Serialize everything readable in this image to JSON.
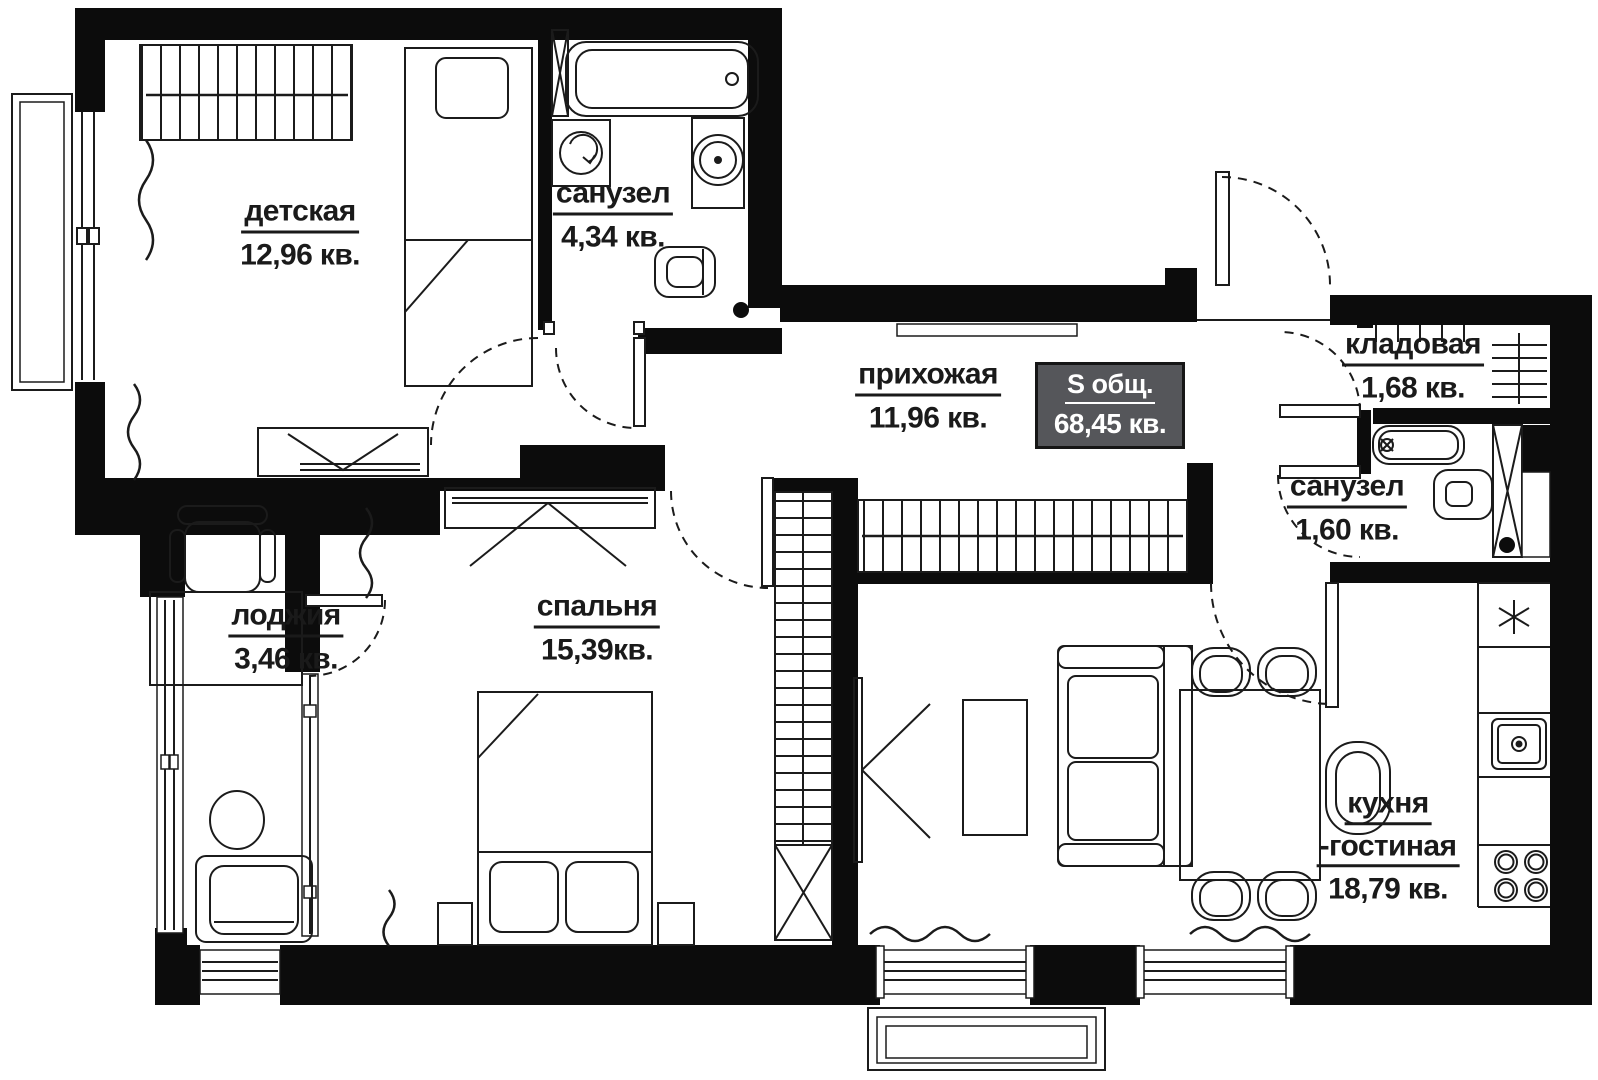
{
  "page": {
    "type": "apartment-floor-plan"
  },
  "badge": {
    "label": "S общ.",
    "value": "68,45 кв."
  },
  "rooms": [
    {
      "name": "детская",
      "area": "12,96 кв."
    },
    {
      "name": "санузел",
      "area": "4,34 кв."
    },
    {
      "name": "прихожая",
      "area": "11,96 кв."
    },
    {
      "name": "кладовая",
      "area": "1,68 кв."
    },
    {
      "name": "санузел",
      "area": "1,60 кв."
    },
    {
      "name": "лоджия",
      "area": "3,46 кв."
    },
    {
      "name": "спальня",
      "area": "15,39кв."
    },
    {
      "name": "кухня",
      "name2": "-гостиная",
      "area": "18,79 кв."
    }
  ],
  "colors": {
    "wall": "#0c0c0c",
    "line": "#1b1b1b",
    "badge_bg": "#55565a",
    "badge_text": "#ffffff",
    "text": "#1a1a1a"
  }
}
